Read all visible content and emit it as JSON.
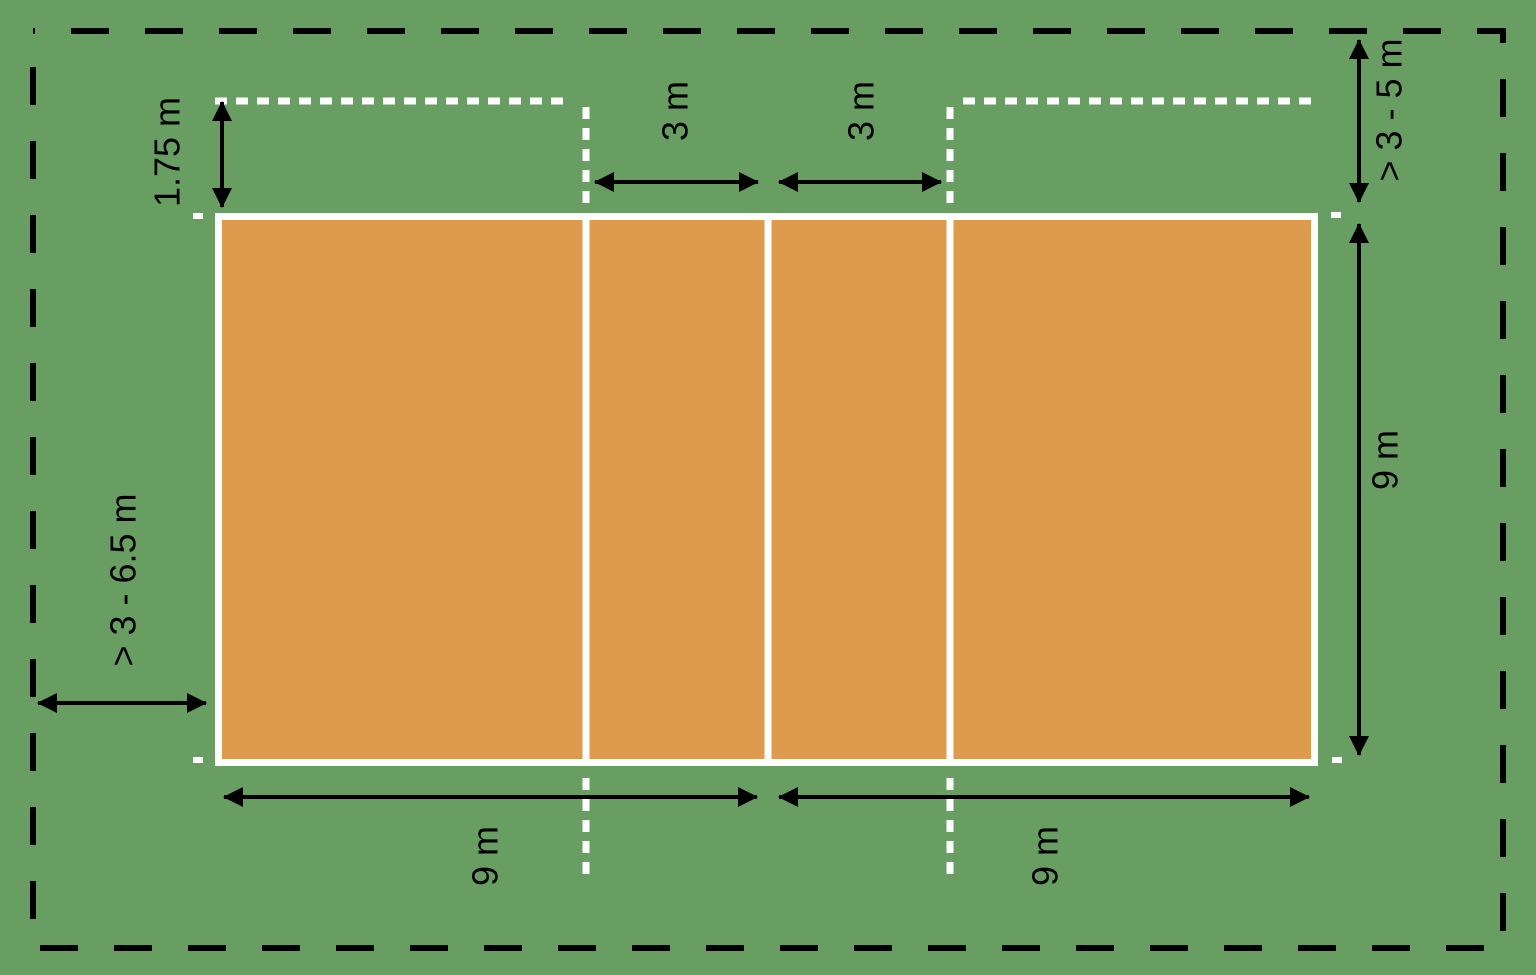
{
  "diagram": {
    "colors": {
      "free_zone_green": "#689e61",
      "court_orange": "#de9a4d",
      "line_white": "#ffffff",
      "annotation_black": "#000000"
    },
    "dimensions": {
      "attack_line_extension": "1.75 m",
      "front_zone_left": "3 m",
      "front_zone_right": "3 m",
      "free_zone_end": "> 3 - 5 m",
      "court_width": "9 m",
      "free_zone_side": "> 3 - 6.5 m",
      "half_court_left": "9 m",
      "half_court_right": "9 m"
    }
  }
}
